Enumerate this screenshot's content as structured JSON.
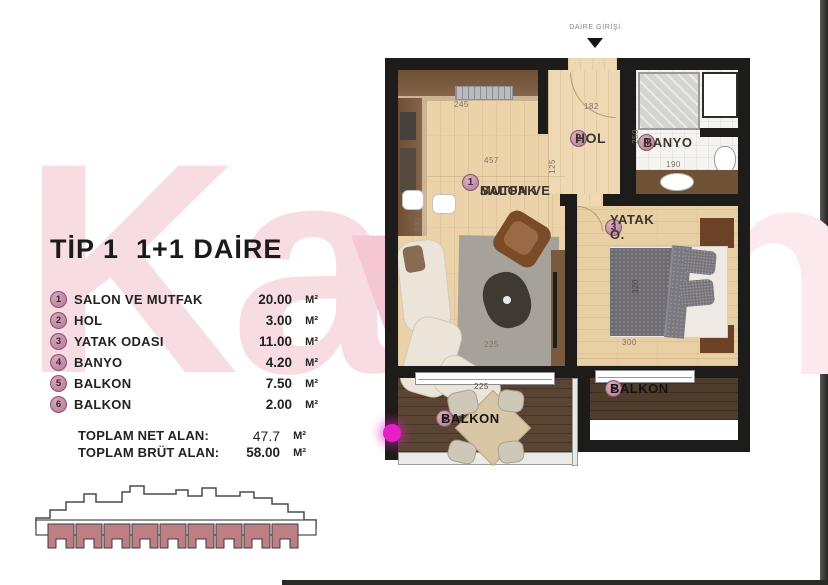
{
  "title": "TİP 1  1+1 DAİRE",
  "legend": {
    "rows": [
      {
        "num": "1",
        "label": "SALON VE MUTFAK",
        "value": "20.00",
        "unit": "M²"
      },
      {
        "num": "2",
        "label": "HOL",
        "value": "3.00",
        "unit": "M²"
      },
      {
        "num": "3",
        "label": "YATAK ODASI",
        "value": "11.00",
        "unit": "M²"
      },
      {
        "num": "4",
        "label": "BANYO",
        "value": "4.20",
        "unit": "M²"
      },
      {
        "num": "5",
        "label": "BALKON",
        "value": "7.50",
        "unit": "M²"
      },
      {
        "num": "6",
        "label": "BALKON",
        "value": "2.00",
        "unit": "M²"
      }
    ],
    "totals": [
      {
        "label": "TOPLAM NET ALAN:",
        "value": "47.7",
        "unit": "M²"
      },
      {
        "label": "TOPLAM BRÜT ALAN:",
        "value": "58.00",
        "unit": "M²"
      }
    ]
  },
  "plan": {
    "entrance_label": "DAİRE GİRİŞİ",
    "rooms": {
      "salon": {
        "num": "1",
        "line1": "SALON VE",
        "line2": "MUTFAK"
      },
      "hol": {
        "num": "2",
        "label": "HOL"
      },
      "yatak": {
        "num": "3",
        "label": "YATAK O."
      },
      "banyo": {
        "num": "4",
        "label": "BANYO"
      },
      "balkon5": {
        "num": "5",
        "label": "BALKON"
      },
      "balkon6": {
        "num": "6",
        "label": "BALKON"
      }
    },
    "dims": {
      "kitchen_w": "245",
      "salon_w": "457",
      "salon_h": "490",
      "salon_bottom": "225",
      "hol_w": "182",
      "hol_h": "125",
      "banyo_h": "250",
      "banyo_w": "190",
      "yatak_w": "300",
      "bed_h": "320",
      "balkon5_w": "225"
    }
  },
  "watermark": {
    "left": "Ka",
    "mid": "v",
    "right": "n"
  },
  "colors": {
    "rose_fill": "#bd7f84",
    "circle_fill": "#b27b93",
    "magenta_dot": "#e61fc6",
    "wall": "#1e1c1a",
    "wood_light": "#ebd2a8",
    "wood_dark": "#5a4533"
  }
}
